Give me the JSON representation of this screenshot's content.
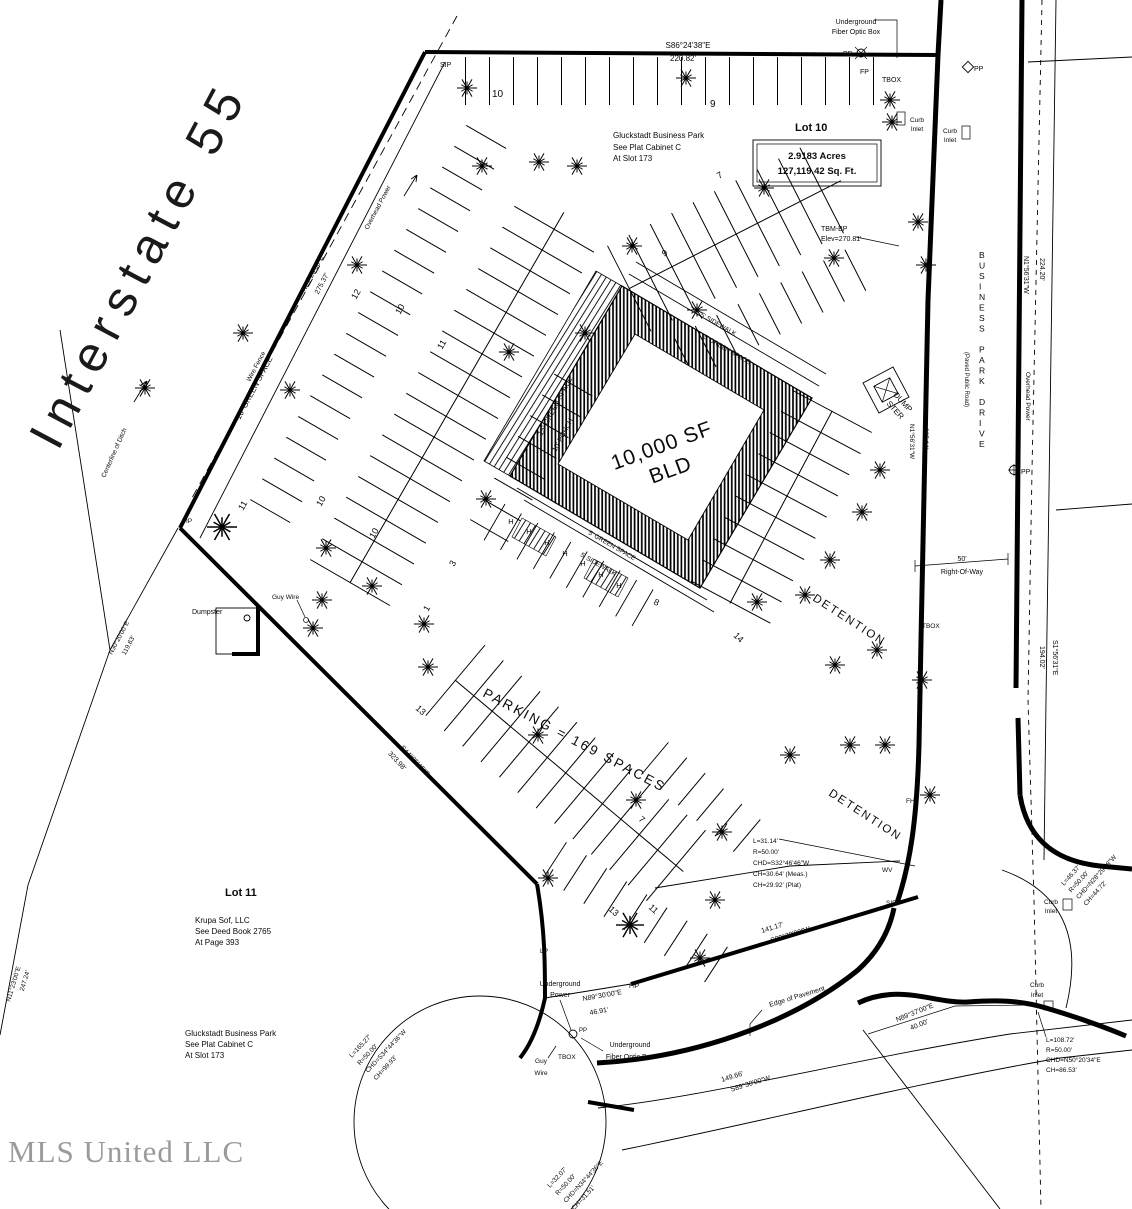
{
  "watermark": "MLS United LLC",
  "interstate_label": "Interstate   55",
  "lot10": {
    "name": "Lot 10",
    "acres": "2.9183 Acres",
    "sqft": "127,119.42 Sq. Ft.",
    "plat": [
      "Gluckstadt Business Park",
      "See Plat Cabinet C",
      "At Slot 173"
    ],
    "parking": "PARKING = 169 SPACES",
    "building_line1": "10,000 SF",
    "building_line2": "BLD"
  },
  "lot11": {
    "name": "Lot 11",
    "owner": [
      "Krupa Sof, LLC",
      "See Deed Book 2765",
      "At Page 393"
    ],
    "plat": [
      "Gluckstadt Business Park",
      "See Plat Cabinet C",
      "At Slot 173"
    ]
  },
  "road": {
    "name": "BUSINESS PARK DRIVE",
    "type": "(Paved Public Road)",
    "row_dim": "50'",
    "row_label": "Right-Of-Way",
    "overhead": "Overhead Power",
    "edge": "Edge of Pavement"
  },
  "bearings": {
    "top_b": "S86°24'38\"E",
    "top_d": "220.82'",
    "i55_b": "N29°20'00\"E",
    "i55_d": "275.37'",
    "sw_b": "S44°05'45\"E",
    "sw_d": "323.98'",
    "s141_b": "S89°30'00\"W",
    "s141_d": "141.17'",
    "s46_b": "N89°30'00\"E",
    "s46_d": "46.91'",
    "e224_b": "N1°56'31\"W",
    "e224_d": "224.20'",
    "e205_b": "N1°56'31\"W",
    "e205_d": "205.14'",
    "e194_b": "S1°56'31\"E",
    "e194_d": "194.02'",
    "ditch1_b": "N30°20'00\"E",
    "ditch1_d": "119.63'",
    "ditch2_b": "N11°23'00\"E",
    "ditch2_d": "247.24'",
    "s149_b": "S89°30'00\"W",
    "s149_d": "149.66'",
    "s40_b": "N89°37'00\"E",
    "s40_d": "40.00'"
  },
  "curves": {
    "c1": [
      "L=31.14'",
      "R=50.00'",
      "CHD=S32°46'46\"W",
      "CH=30.64' (Meas.)",
      "CH=29.92' (Plat)"
    ],
    "c2": [
      "L=165.27'",
      "R=50.00'",
      "CHD=S34°44'36\"W",
      "CH=99.93'"
    ],
    "c3": [
      "L=32.07'",
      "R=50.00'",
      "CHD=N34°44'36\"E",
      "CH=31.51'"
    ],
    "c4": [
      "L=108.72'",
      "R=50.00'",
      "CHD=N50°20'34\"E",
      "CH=86.53'"
    ],
    "c5": [
      "L=46.37'",
      "R=50.00'",
      "CHD=N28°29'58\"W",
      "CH=44.72'"
    ]
  },
  "site": {
    "green10": "10' GREEN SPACE",
    "green15": "15' GREEN SPACE",
    "green5a": "5' GREEN SPACE",
    "side5a": "5' SIDEWALK",
    "green5b": "5' GREEN SPACE",
    "side5b": "5' SIDEWALK",
    "porch": "10' PORCH",
    "detention1": "DETENTION",
    "detention2": "DETENTION",
    "dumpster": "Dumpster",
    "dump1": "DUMP",
    "dump2": "STER",
    "wire_fence": "Wire Fence",
    "ditch": "Centerline of Ditch",
    "tbm1": "TBM-BP",
    "tbm2": "Elev=270.81'",
    "guy1": "Guy Wire",
    "guy2a": "Guy",
    "guy2b": "Wire",
    "upower1": "Underground",
    "upower2": "Power",
    "fiber1": "Underground",
    "fiber2": "Fiber Optic Box",
    "curb": "Curb",
    "inlet": "Inlet"
  },
  "marks": {
    "sip": "SIP",
    "fip": "FIP",
    "fp": "FP",
    "pp": "PP",
    "tbox": "TBOX",
    "lp": "LP",
    "fh": "FH",
    "wv": "WV"
  },
  "counts": [
    "10",
    "9",
    "7",
    "9",
    "12",
    "10",
    "11",
    "11",
    "10",
    "10",
    "3",
    "1",
    "8",
    "13",
    "7",
    "14",
    "13",
    "11"
  ],
  "handicap": "H"
}
